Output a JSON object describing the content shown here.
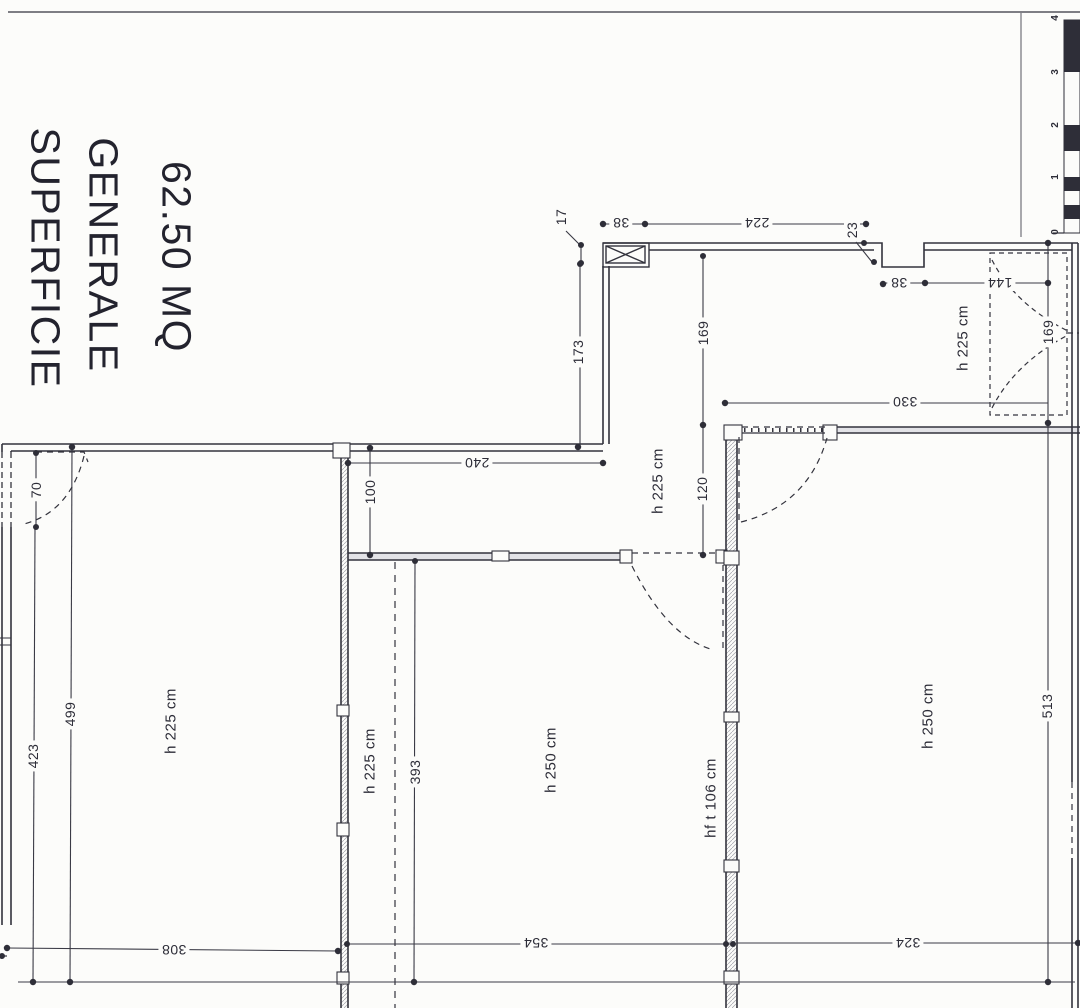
{
  "title": {
    "line1": "SUPERFICIE",
    "line2": "GENERALE",
    "area": "62.50 MQ"
  },
  "colors": {
    "ink": "#33333d",
    "paper": "#fcfcfa",
    "wall_hatch": "#9a9aa2"
  },
  "scale_bar": {
    "numbers": [
      "0",
      "1",
      "2",
      "3",
      "4"
    ]
  },
  "labels": [
    {
      "name": "dim-38-top",
      "cls": "dim",
      "text": "38",
      "x": 621,
      "y": 223,
      "rot": 180
    },
    {
      "name": "dim-224",
      "cls": "dim",
      "text": "224",
      "x": 757,
      "y": 223,
      "rot": 180
    },
    {
      "name": "dim-17",
      "cls": "dim",
      "text": "17",
      "x": 561,
      "y": 217,
      "rot": -90
    },
    {
      "name": "dim-23",
      "cls": "dim",
      "text": "23",
      "x": 852,
      "y": 230,
      "rot": -90
    },
    {
      "name": "dim-38-right",
      "cls": "dim",
      "text": "38",
      "x": 899,
      "y": 283,
      "rot": 180
    },
    {
      "name": "dim-144",
      "cls": "dim",
      "text": "144",
      "x": 1000,
      "y": 283,
      "rot": 180
    },
    {
      "name": "dim-173",
      "cls": "dim",
      "text": "173",
      "x": 578,
      "y": 352,
      "rot": -90
    },
    {
      "name": "dim-169-mid",
      "cls": "dim",
      "text": "169",
      "x": 703,
      "y": 333,
      "rot": -90
    },
    {
      "name": "dim-169-right",
      "cls": "dim",
      "text": "169",
      "x": 1048,
      "y": 332,
      "rot": -90
    },
    {
      "name": "dim-330",
      "cls": "dim",
      "text": "330",
      "x": 905,
      "y": 402,
      "rot": 180
    },
    {
      "name": "dim-240",
      "cls": "dim",
      "text": "240",
      "x": 477,
      "y": 463,
      "rot": 180
    },
    {
      "name": "dim-100",
      "cls": "dim",
      "text": "100",
      "x": 370,
      "y": 492,
      "rot": -90
    },
    {
      "name": "dim-120",
      "cls": "dim",
      "text": "120",
      "x": 702,
      "y": 489,
      "rot": -90
    },
    {
      "name": "dim-70",
      "cls": "dim",
      "text": "70",
      "x": 36,
      "y": 490,
      "rot": -90
    },
    {
      "name": "dim-499",
      "cls": "dim",
      "text": "499",
      "x": 70,
      "y": 714,
      "rot": -90
    },
    {
      "name": "dim-423",
      "cls": "dim",
      "text": "423",
      "x": 33,
      "y": 756,
      "rot": -90
    },
    {
      "name": "dim-393",
      "cls": "dim",
      "text": "393",
      "x": 415,
      "y": 772,
      "rot": -90
    },
    {
      "name": "dim-513",
      "cls": "dim",
      "text": "513",
      "x": 1047,
      "y": 706,
      "rot": -90
    },
    {
      "name": "dim-308",
      "cls": "dim",
      "text": "308",
      "x": 174,
      "y": 950,
      "rot": 180
    },
    {
      "name": "dim-354",
      "cls": "dim",
      "text": "354",
      "x": 536,
      "y": 943,
      "rot": 180
    },
    {
      "name": "dim-324",
      "cls": "dim",
      "text": "324",
      "x": 908,
      "y": 943,
      "rot": 180
    },
    {
      "name": "room-h225-topright",
      "cls": "room",
      "text": "h 225 cm",
      "x": 963,
      "y": 338,
      "rot": -90
    },
    {
      "name": "room-h225-hall",
      "cls": "room",
      "text": "h 225 cm",
      "x": 658,
      "y": 481,
      "rot": -90
    },
    {
      "name": "room-h225-left",
      "cls": "room",
      "text": "h 225 cm",
      "x": 171,
      "y": 721,
      "rot": -90
    },
    {
      "name": "room-h225-mid",
      "cls": "room",
      "text": "h 225 cm",
      "x": 370,
      "y": 761,
      "rot": -90
    },
    {
      "name": "room-h250-mid",
      "cls": "room",
      "text": "h 250 cm",
      "x": 551,
      "y": 760,
      "rot": -90
    },
    {
      "name": "room-hft106",
      "cls": "room",
      "text": "hf t 106 cm",
      "x": 711,
      "y": 798,
      "rot": -90
    },
    {
      "name": "room-h250-right",
      "cls": "room",
      "text": "h 250 cm",
      "x": 928,
      "y": 716,
      "rot": -90
    },
    {
      "name": "scale-number-4",
      "cls": "scale",
      "text": "4",
      "x": 1056,
      "y": 18,
      "rot": -90
    },
    {
      "name": "scale-number-3",
      "cls": "scale",
      "text": "3",
      "x": 1056,
      "y": 72,
      "rot": -90
    },
    {
      "name": "scale-number-2",
      "cls": "scale",
      "text": "2",
      "x": 1056,
      "y": 125,
      "rot": -90
    },
    {
      "name": "scale-number-1",
      "cls": "scale",
      "text": "1",
      "x": 1056,
      "y": 177,
      "rot": -90
    },
    {
      "name": "scale-number-0",
      "cls": "scale",
      "text": "0",
      "x": 1056,
      "y": 232,
      "rot": -90
    }
  ]
}
